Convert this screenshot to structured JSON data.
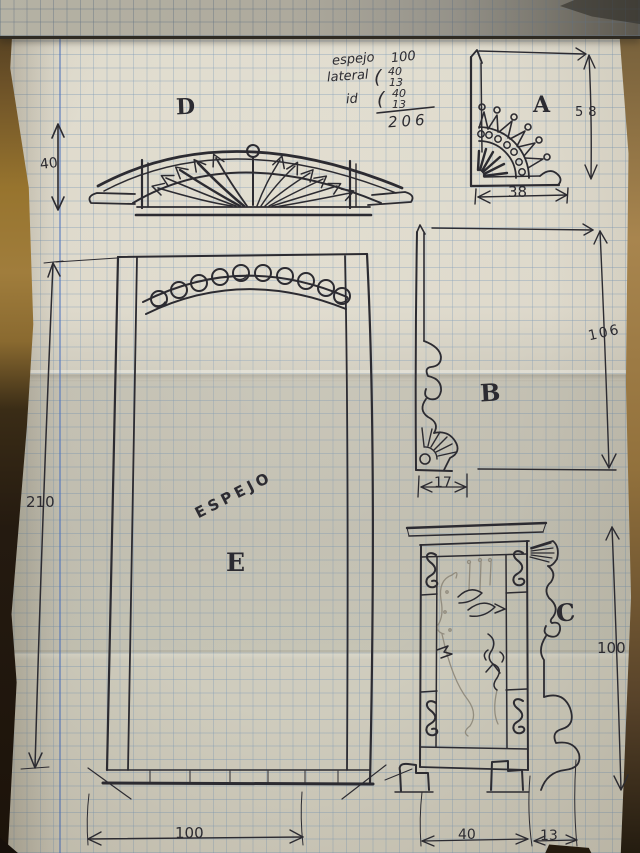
{
  "notes": {
    "line1": {
      "label": "espejo",
      "value": "100"
    },
    "line2": {
      "label": "lateral",
      "brace": "(",
      "top": "40",
      "bottom": "13"
    },
    "line3": {
      "label": "id",
      "brace": "(",
      "top": "40",
      "bottom": "13"
    },
    "total": "206"
  },
  "details": {
    "d": {
      "label": "D",
      "dim_height": "40"
    },
    "a": {
      "label": "A",
      "dim_height": "58",
      "dim_width": "38"
    },
    "b": {
      "label": "B",
      "dim_height": "106",
      "dim_width": "17"
    },
    "c": {
      "label": "C",
      "dim_height": "100",
      "dim_width": "40",
      "dim_foot": "13"
    },
    "e": {
      "label": "E",
      "dim_height": "210",
      "dim_width": "100",
      "inscription": "ESPEJO"
    }
  },
  "colors": {
    "ink": "#2c2b31",
    "pencil": "#8d8779",
    "grid_blue": "#7a98b6",
    "paper": "#d9d5c7",
    "wood": "#8d6d36"
  }
}
